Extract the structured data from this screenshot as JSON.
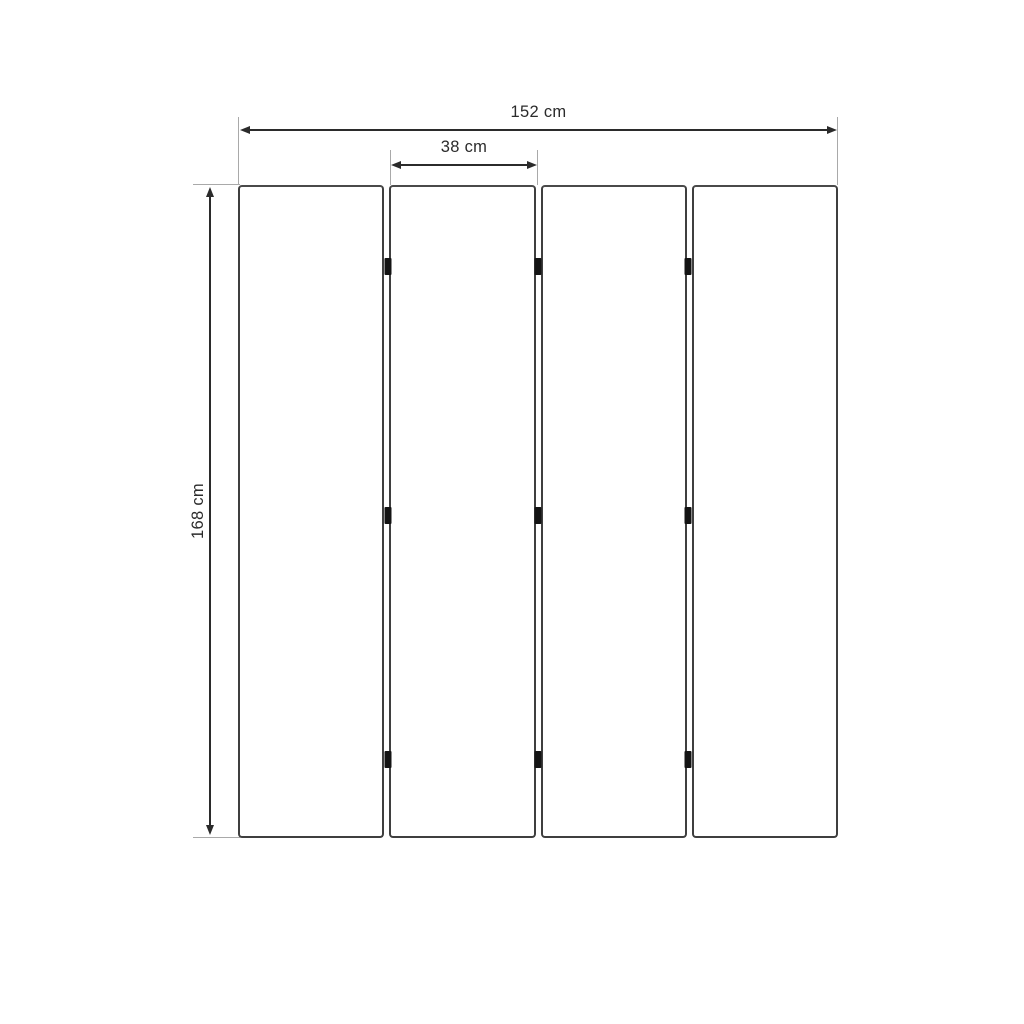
{
  "diagram": {
    "subject": "four-panel folding screen dimension drawing, front view",
    "panel_count": 4,
    "joints": 3,
    "hinges_per_joint": 3,
    "labels": {
      "total_width": "152 cm",
      "panel_width": "38 cm",
      "height": "168 cm"
    },
    "colors": {
      "background": "#ffffff",
      "panel_outline": "#3f3f3f",
      "panel_fill": "#ffffff",
      "dimension_line": "#2b2b2b",
      "extension_line": "#a9a9a9",
      "hinge": "#141414",
      "label_text": "#2b2b2b"
    }
  }
}
